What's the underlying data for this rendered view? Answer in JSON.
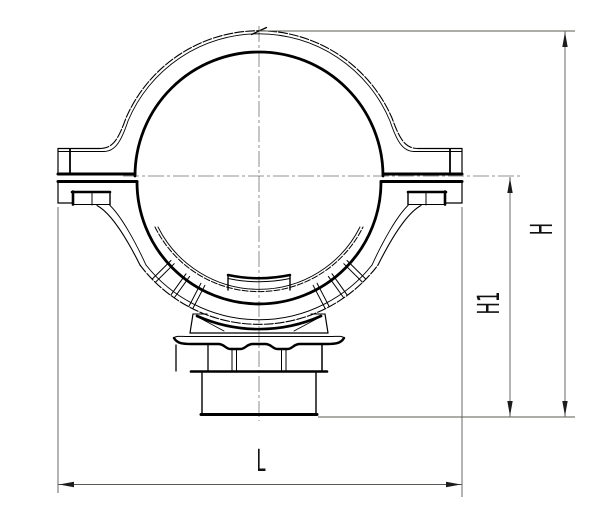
{
  "drawing": {
    "description": "Cross-section technical drawing of a pipe saddle clamp with bottom outlet",
    "background_color": "#ffffff",
    "outline_color": "#000000",
    "dimension_line_color": "#5b5953",
    "dimensions": {
      "overall_height": "H",
      "center_to_base_height": "H1",
      "overall_width": "L"
    }
  }
}
